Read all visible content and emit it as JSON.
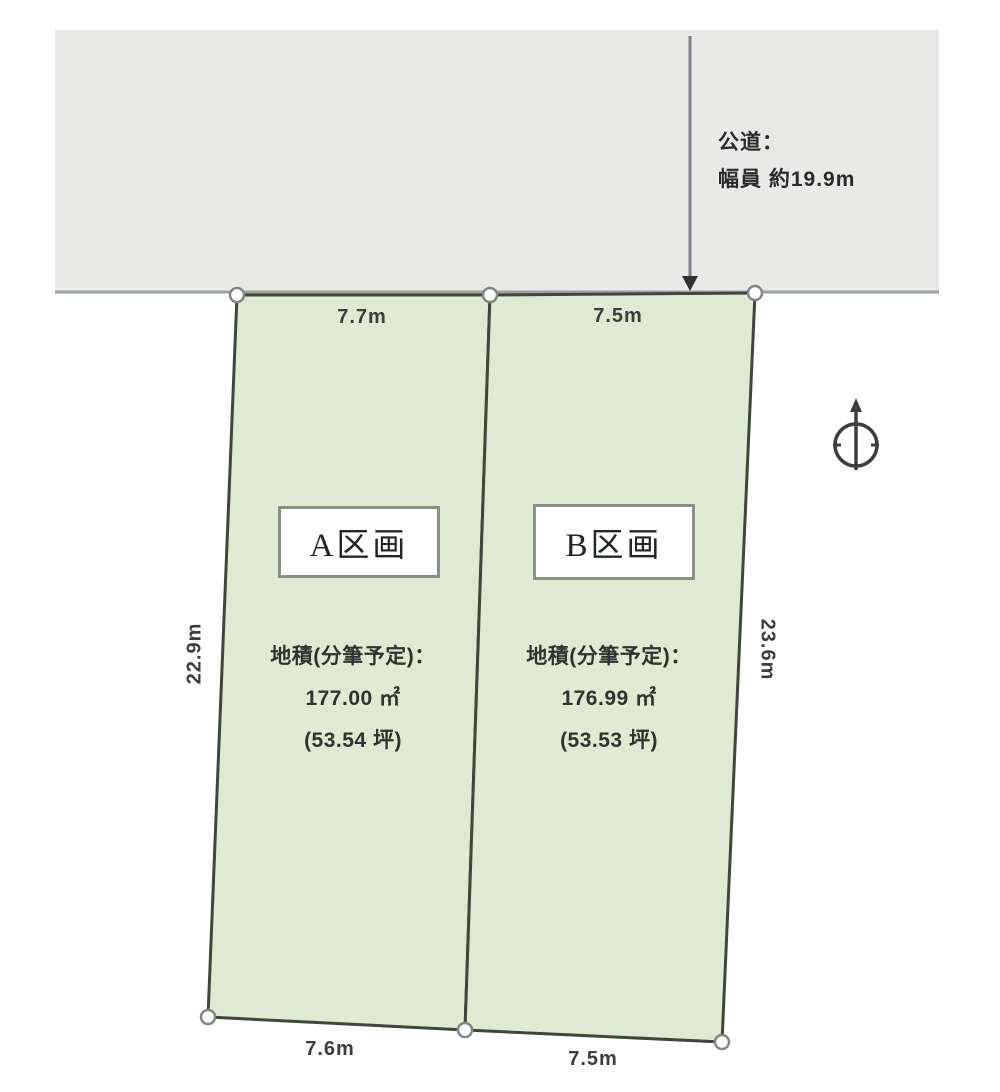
{
  "road": {
    "label_line1": "公道：",
    "label_line2": "幅員 約19.9m"
  },
  "plots": [
    {
      "id": "A",
      "label": "A区画",
      "area_title": "地積(分筆予定)：",
      "area_m2": "177.00 ㎡",
      "area_tsubo": "(53.54 坪)",
      "top_width": "7.7m",
      "bottom_width": "7.6m",
      "side_length": "22.9m"
    },
    {
      "id": "B",
      "label": "B区画",
      "area_title": "地積(分筆予定)：",
      "area_m2": "176.99 ㎡",
      "area_tsubo": "(53.53 坪)",
      "top_width": "7.5m",
      "bottom_width": "7.5m",
      "side_length": "23.6m"
    }
  ],
  "icons": {
    "north_compass": "north-compass-icon",
    "road_arrow": "down-arrow-icon"
  },
  "colors": {
    "road_fill": "#e9e9e8",
    "road_edge": "#9aa0a0",
    "plot_fill": "#deead1",
    "plot_border": "#3f463d",
    "vertex_fill": "#ffffff",
    "vertex_stroke": "#808884",
    "text_dark": "#2f3432"
  }
}
